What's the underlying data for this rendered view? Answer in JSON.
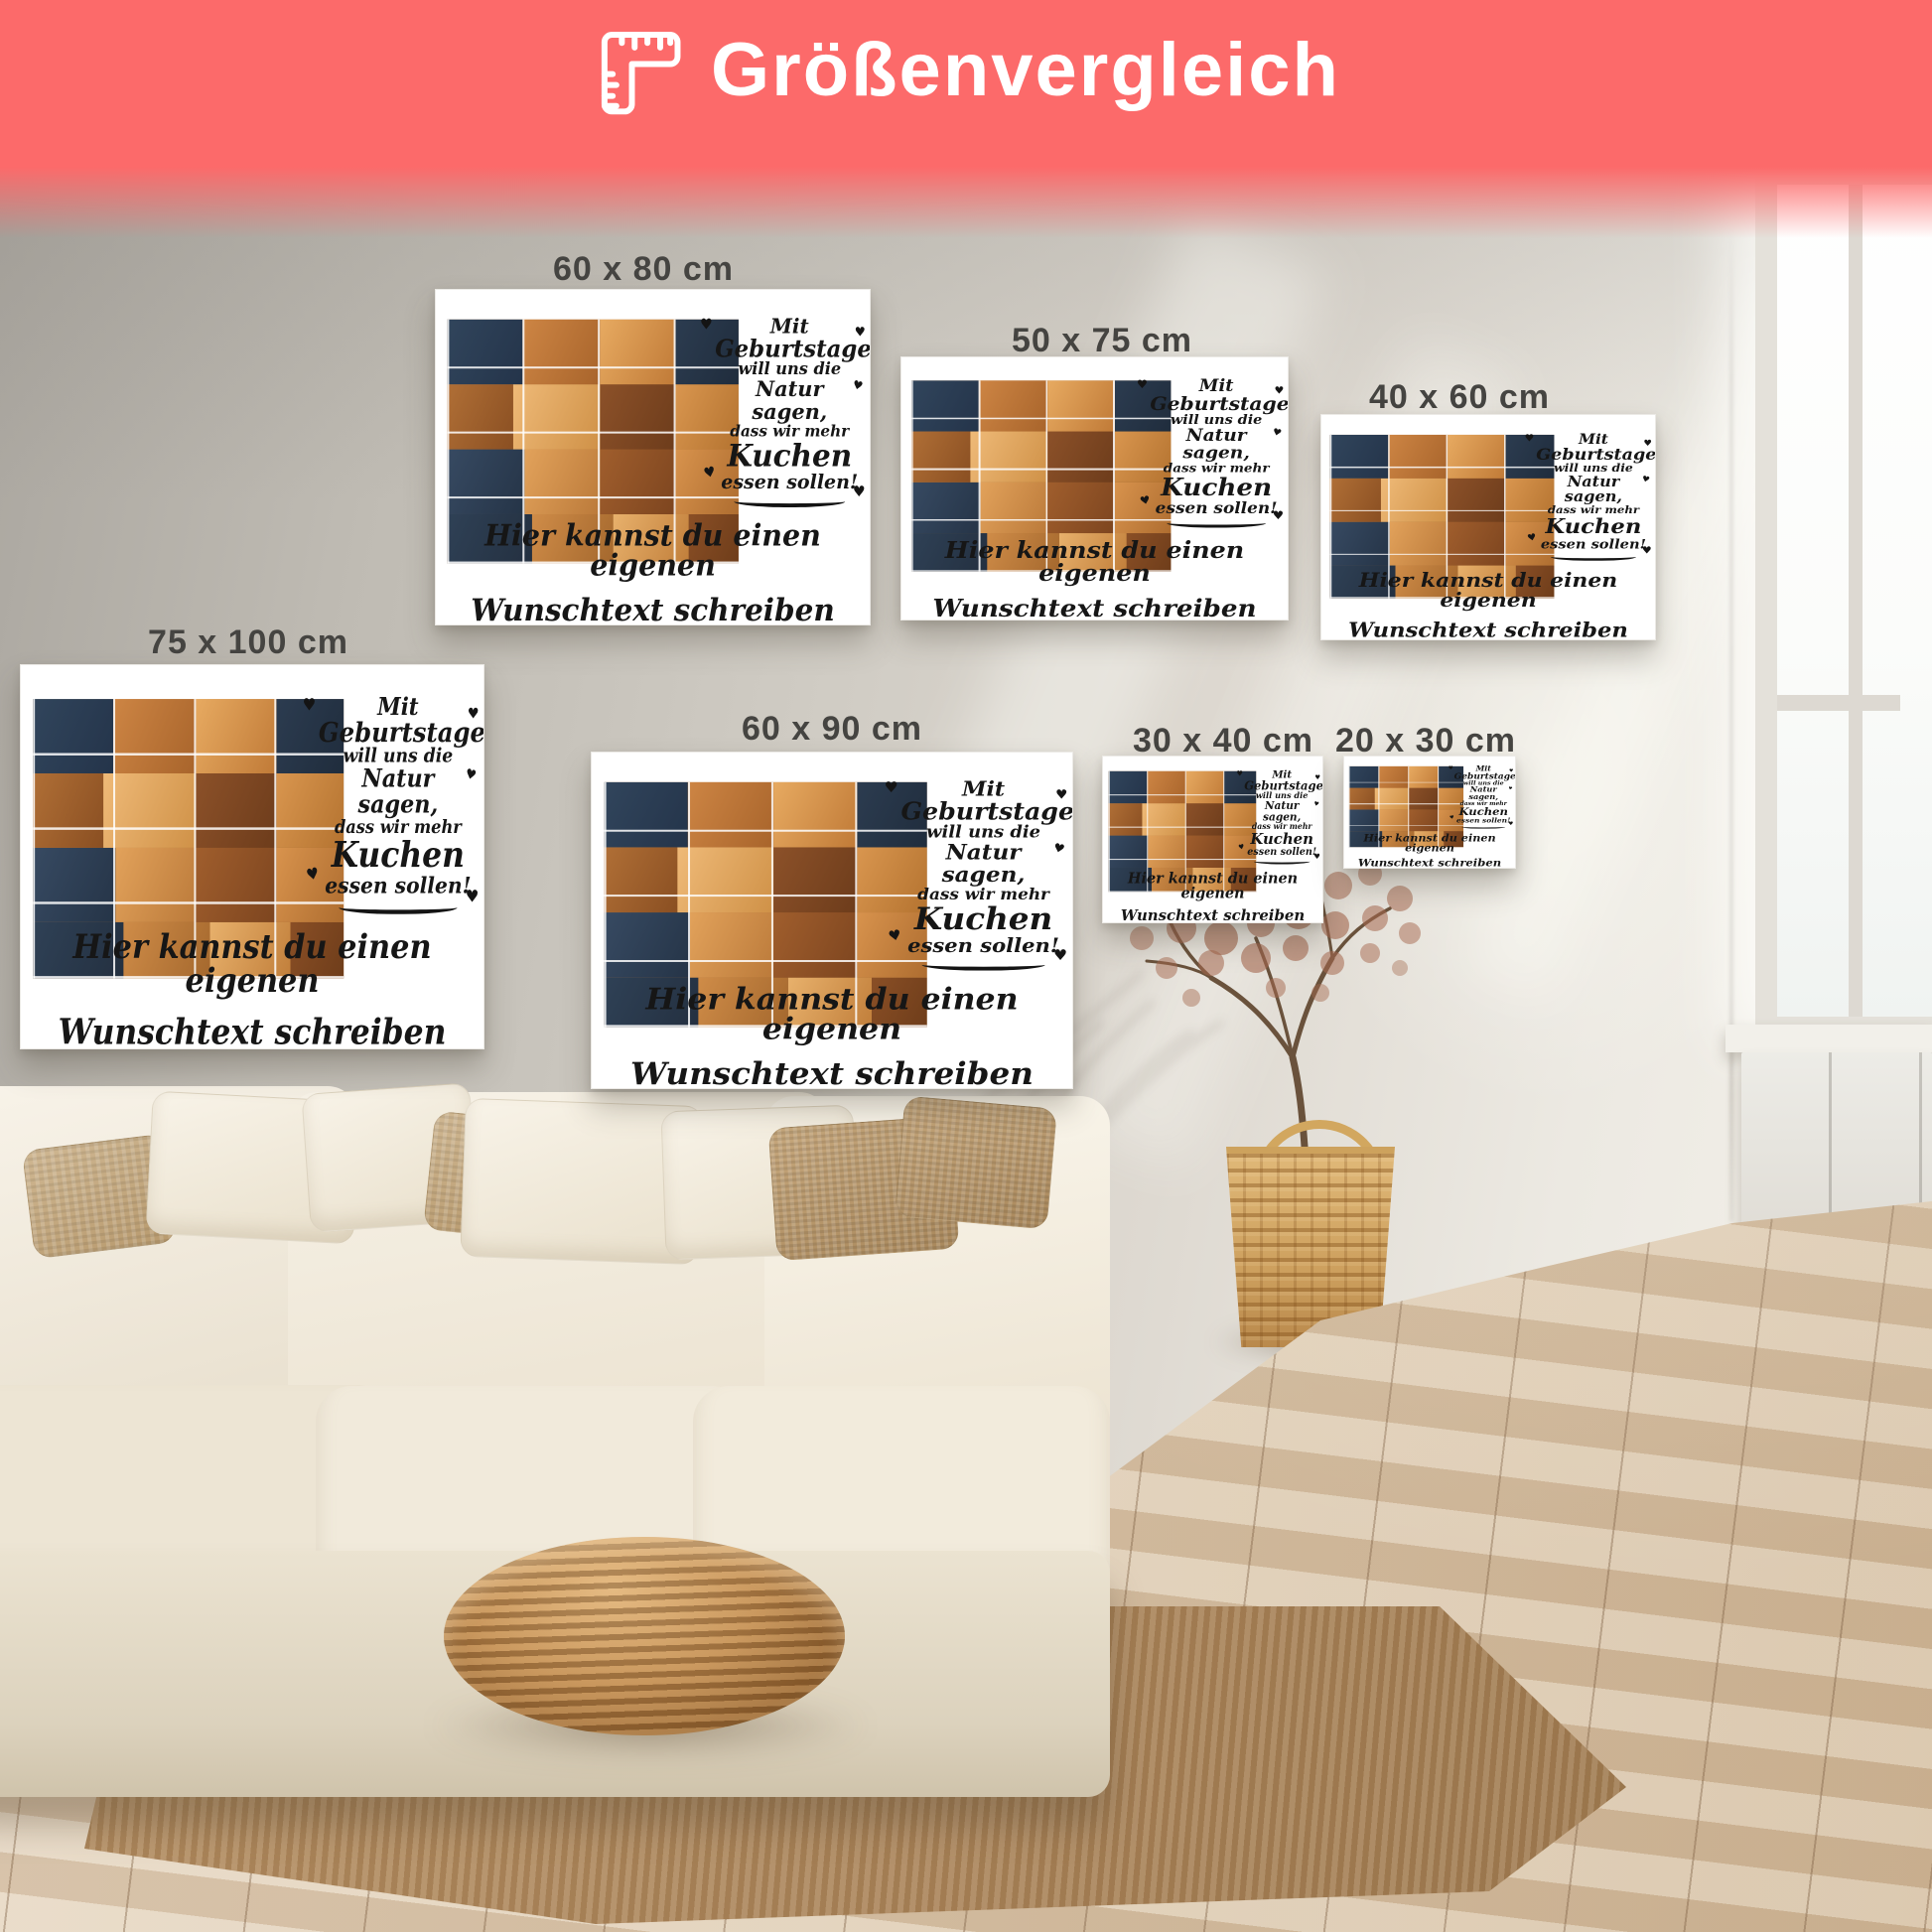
{
  "header": {
    "title": "Größenvergleich"
  },
  "sizes": [
    {
      "label": "60 x 80 cm"
    },
    {
      "label": "50 x 75 cm"
    },
    {
      "label": "40 x 60 cm"
    },
    {
      "label": "75 x 100 cm"
    },
    {
      "label": "60 x 90 cm"
    },
    {
      "label": "30 x 40 cm"
    },
    {
      "label": "20 x 30 cm"
    }
  ],
  "canvas_design": {
    "number": "90",
    "phrase_lines": [
      "Mit",
      "Geburtstagen",
      "will uns die",
      "Natur sagen,",
      "dass wir mehr",
      "Kuchen",
      "essen sollen!"
    ],
    "custom_text_lines": [
      "Hier kannst du einen eigenen",
      "Wunschtext schreiben"
    ],
    "heart_icon": "♥"
  },
  "colors": {
    "banner": "#fc6a6a",
    "canvas_background": "#ffffff",
    "design_text": "#161616",
    "label_text": "#454441"
  }
}
